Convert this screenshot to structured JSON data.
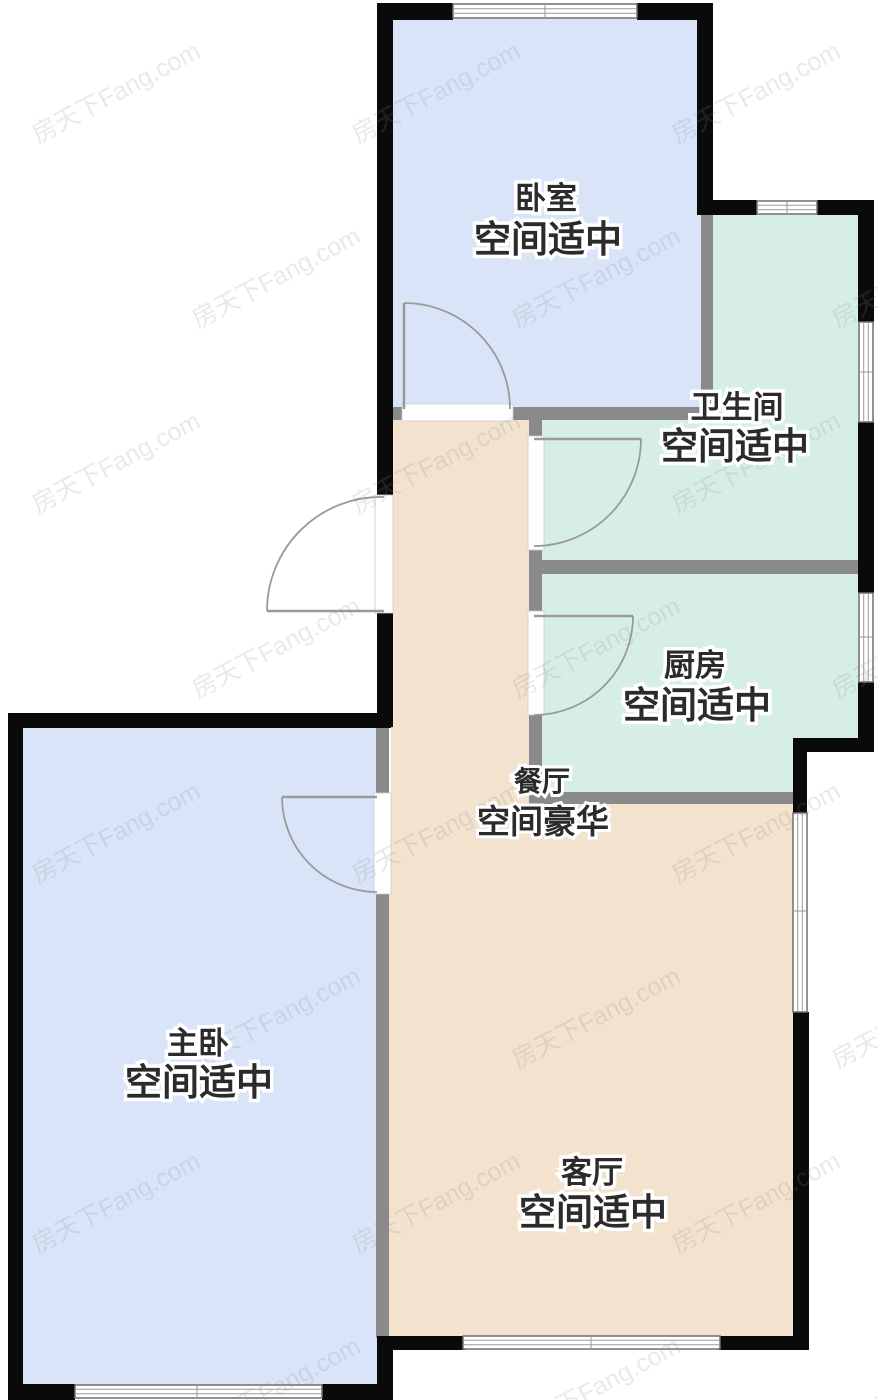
{
  "colors": {
    "room_blue": "#d9e4f8",
    "room_teal": "#d7eee6",
    "room_beige": "#f3e2ce",
    "wall_black": "#0a0a0a",
    "wall_grey": "#8a8a8a"
  },
  "rooms": {
    "bedroom": {
      "name": "卧室",
      "size_desc": "空间适中"
    },
    "bathroom": {
      "name": "卫生间",
      "size_desc": "空间适中"
    },
    "kitchen": {
      "name": "厨房",
      "size_desc": "空间适中"
    },
    "dining": {
      "name": "餐厅",
      "size_desc": "空间豪华"
    },
    "master_bedroom": {
      "name": "主卧",
      "size_desc": "空间适中"
    },
    "living": {
      "name": "客厅",
      "size_desc": "空间适中"
    }
  },
  "watermark": {
    "text": "房天下Fang.com"
  }
}
